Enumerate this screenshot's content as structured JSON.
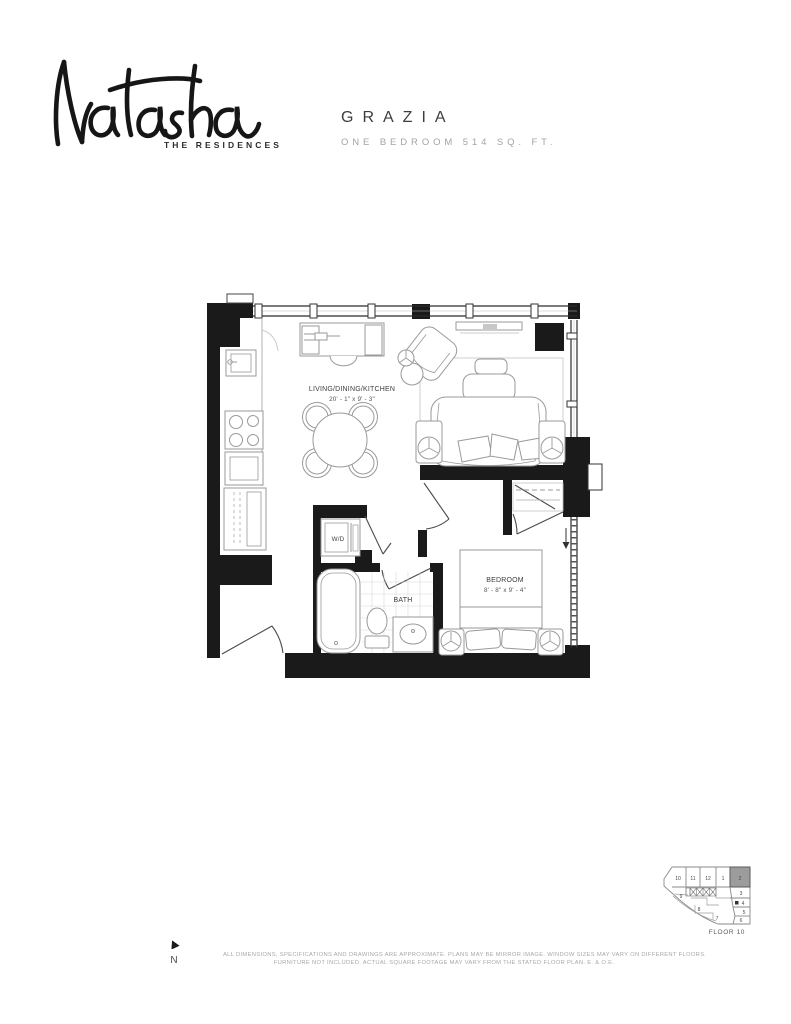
{
  "header": {
    "logo_script": "Natasha",
    "logo_subtitle": "THE RESIDENCES",
    "plan_name": "GRAZIA",
    "plan_subtitle": "ONE BEDROOM 514 SQ. FT."
  },
  "floorplan": {
    "rooms": [
      {
        "name": "LIVING/DINING/KITCHEN",
        "dims": "20' - 1\" x 9' - 3\""
      },
      {
        "name": "BEDROOM",
        "dims": "8' - 8\" x 9' - 4\""
      },
      {
        "name": "BATH",
        "dims": ""
      },
      {
        "name": "W/D",
        "dims": ""
      }
    ]
  },
  "keyplan": {
    "floor_label": "FLOOR 10",
    "highlighted_unit": "2",
    "highlight_color": "#9c9c9c",
    "units": [
      "10",
      "11",
      "12",
      "1",
      "2",
      "3",
      "4",
      "5",
      "6",
      "7",
      "8",
      "9"
    ]
  },
  "compass": {
    "label": "N"
  },
  "disclaimer": {
    "line1": "ALL DIMENSIONS, SPECIFICATIONS AND DRAWINGS ARE APPROXIMATE. PLANS MAY BE MIRROR IMAGE. WINDOW SIZES MAY VARY ON DIFFERENT FLOORS.",
    "line2": "FURNITURE NOT INCLUDED. ACTUAL SQUARE FOOTAGE MAY VARY FROM THE STATED FLOOR PLAN. E. & O.E."
  },
  "colors": {
    "wall": "#1a1a1a",
    "fixture_line": "#9a9a9a",
    "label_text": "#3d3d3d",
    "muted_text": "#a8a8a8"
  }
}
